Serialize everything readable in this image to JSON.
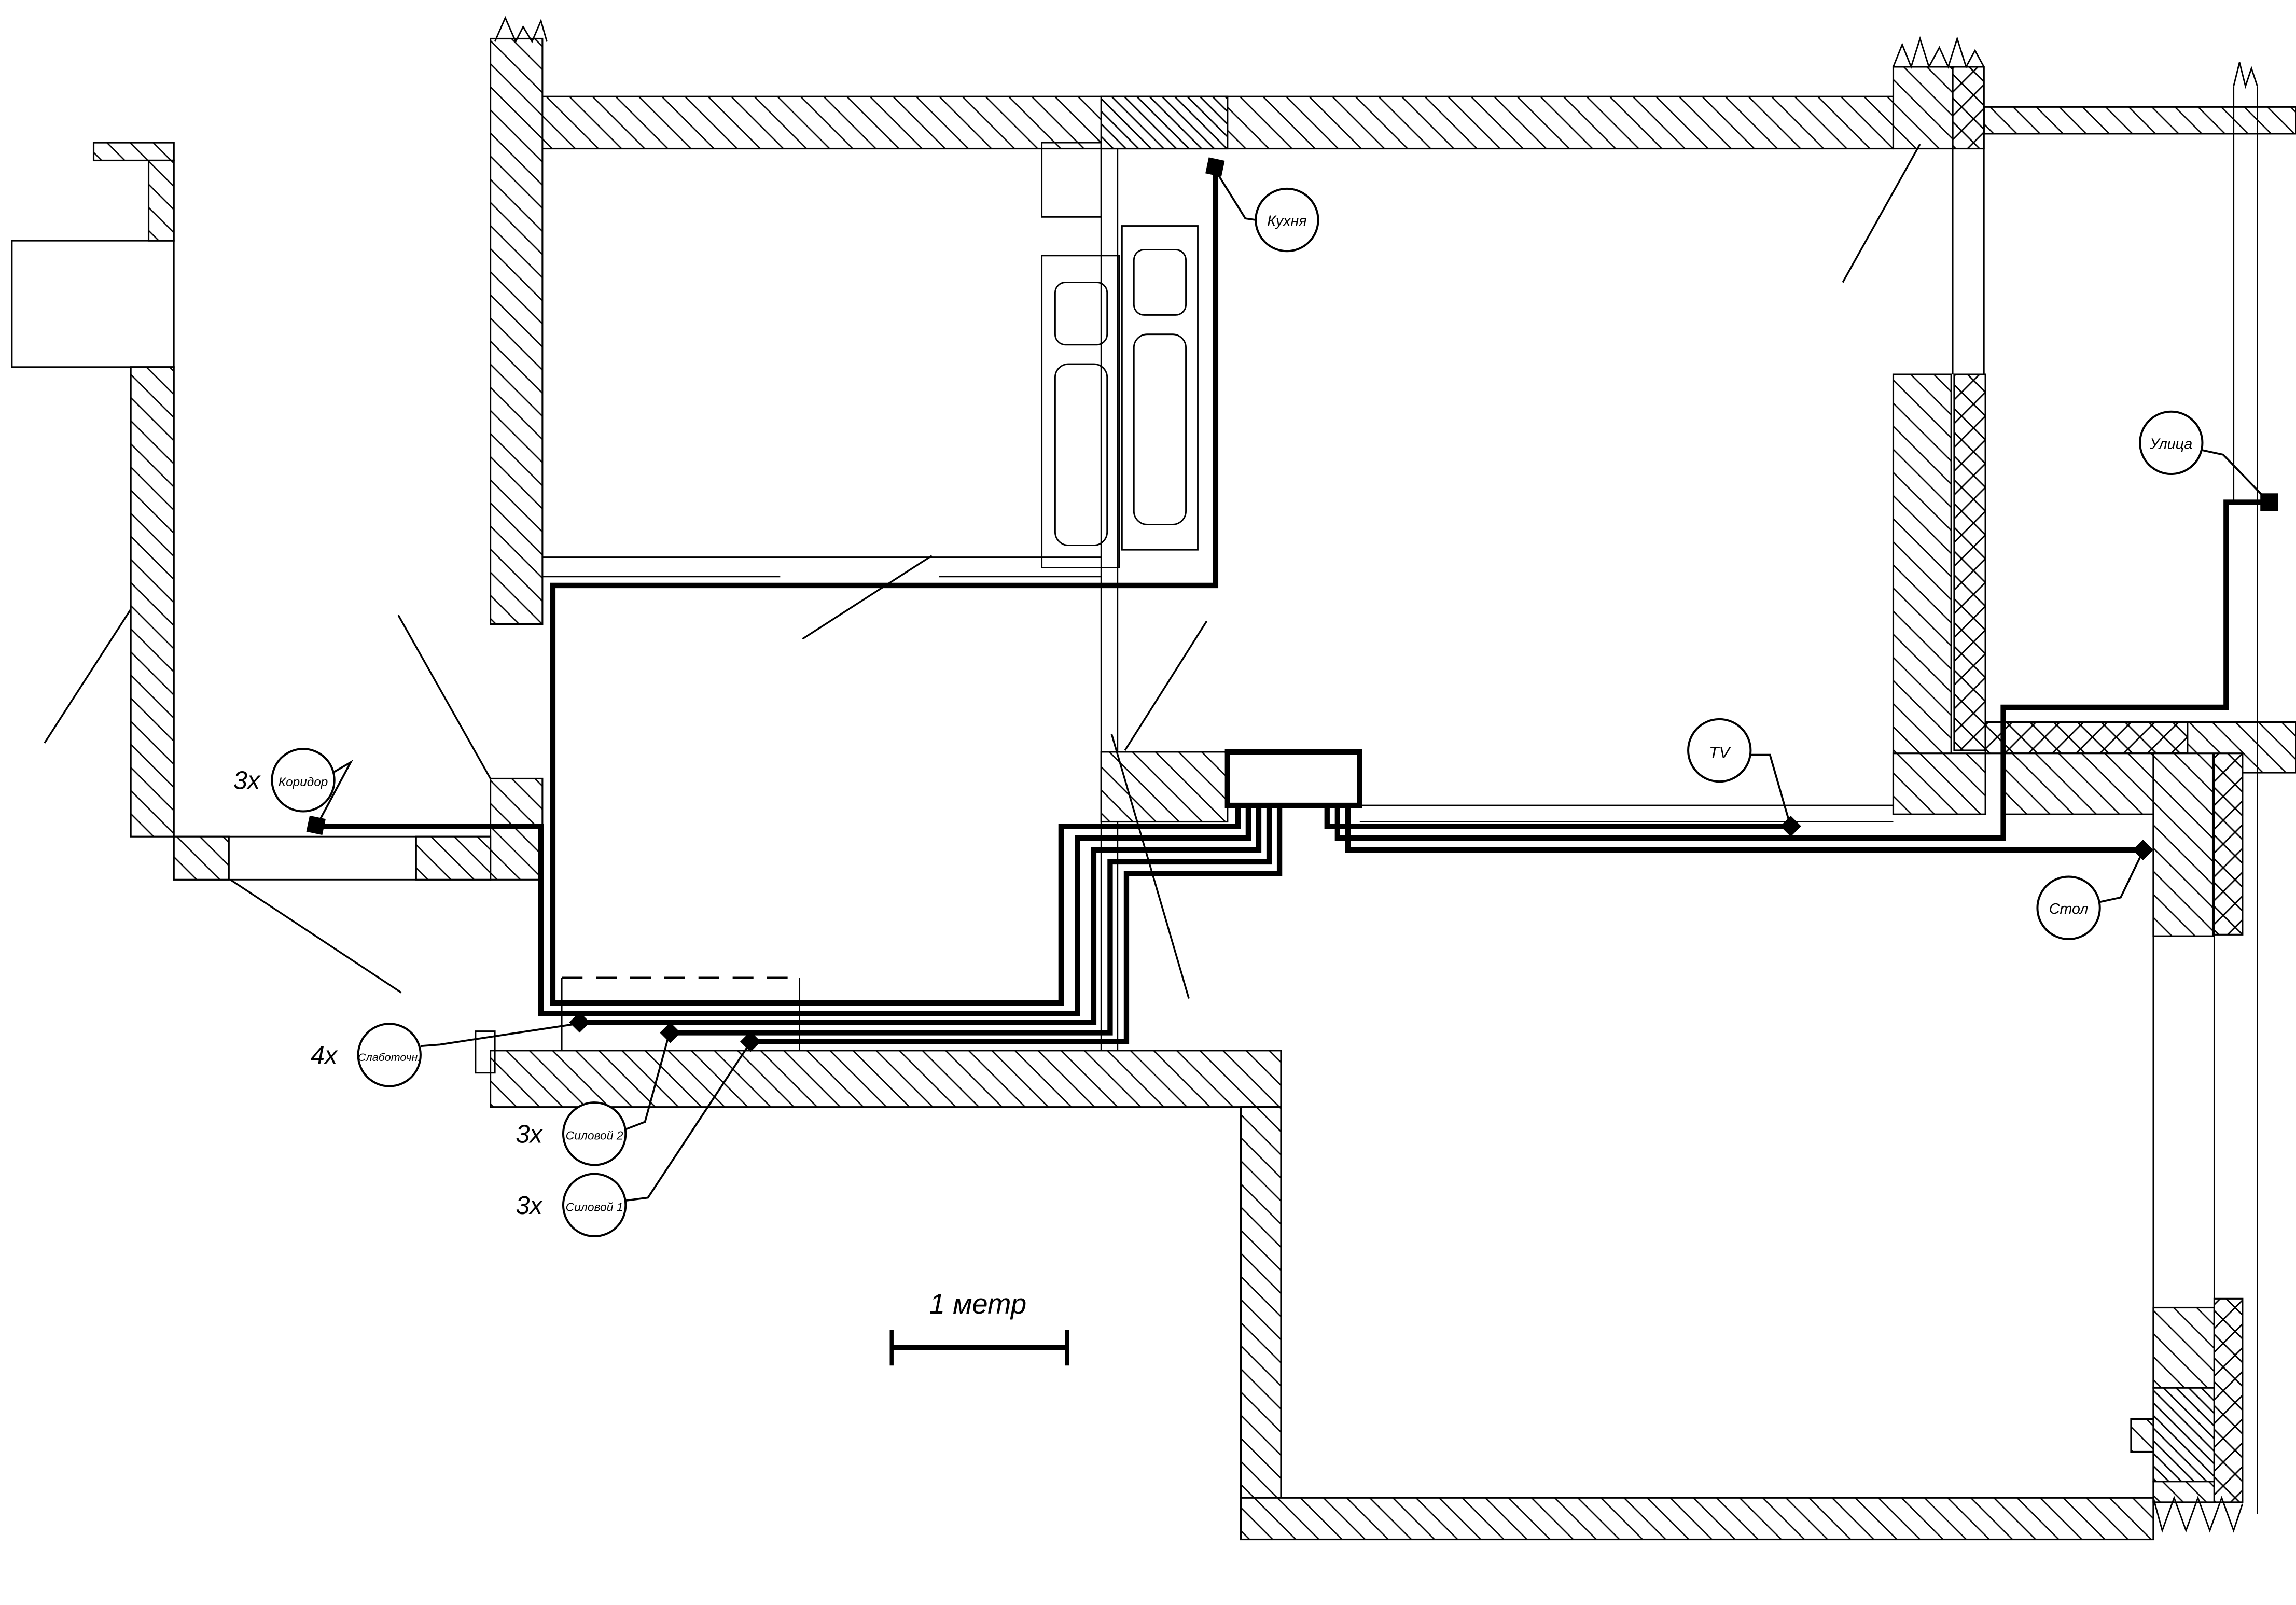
{
  "title": "Схема прокладки кабелей (план квартиры)",
  "colors": {
    "ink": "#000000",
    "paper": "#ffffff"
  },
  "scale_bar": {
    "label": "1 метр"
  },
  "callouts": {
    "kitchen": {
      "text": "Кухня",
      "multiplier": ""
    },
    "corridor": {
      "text": "Коридор",
      "multiplier": "3x"
    },
    "low_current": {
      "text": "Слаботочн.",
      "multiplier": "4x"
    },
    "power2": {
      "text": "Силовой 2",
      "multiplier": "3x"
    },
    "power1": {
      "text": "Силовой 1",
      "multiplier": "3x"
    },
    "tv": {
      "text": "TV",
      "multiplier": ""
    },
    "table": {
      "text": "Стол",
      "multiplier": ""
    },
    "street": {
      "text": "Улица",
      "multiplier": ""
    }
  }
}
